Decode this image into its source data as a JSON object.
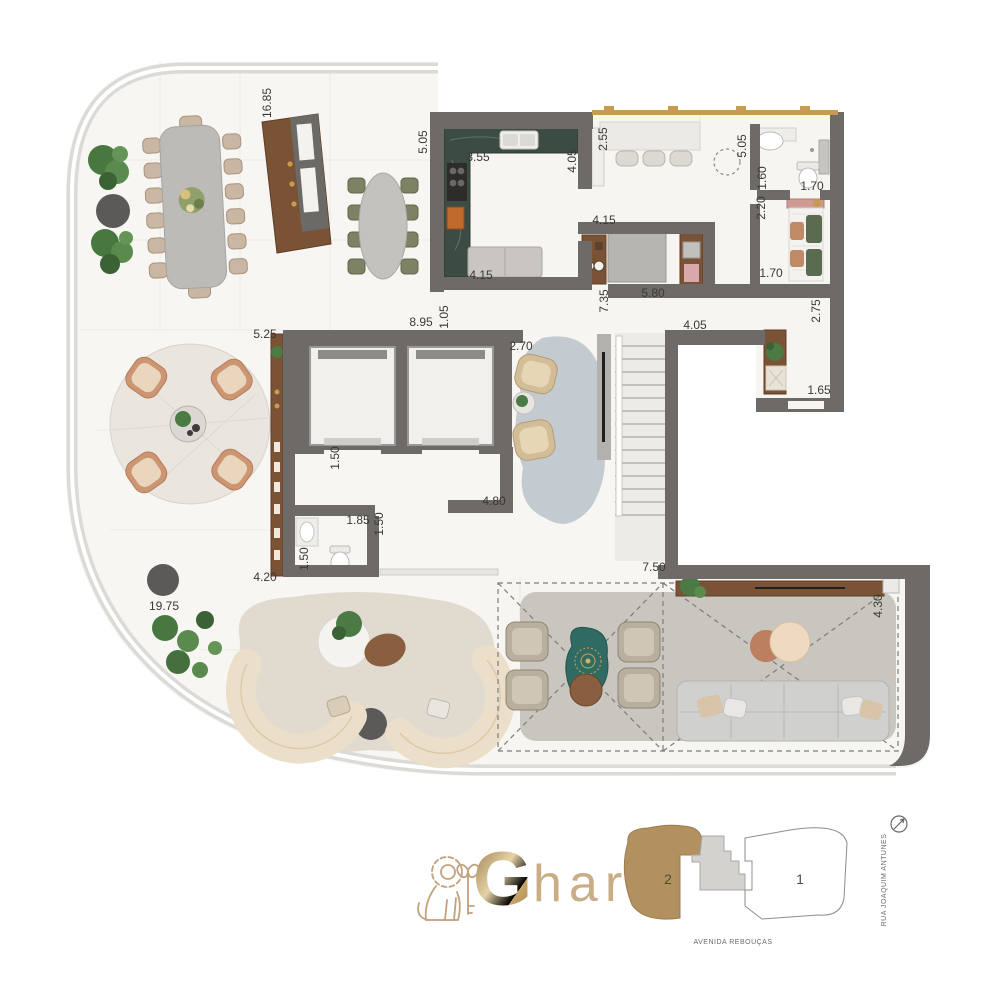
{
  "colors": {
    "wall": "#6d6a67",
    "slab_band": "#d9d7d4",
    "floor": "#f8f6f2",
    "kitchen_counter_green": "#3c4c45",
    "wood": "#7a5236",
    "window_gold": "#c79b50",
    "logo_gold": "#c2a17c",
    "keyplan_highlight": "#b3905f",
    "teal_table": "#2f6b62",
    "rug_blue_gray": "#bec6cc",
    "terrace_rug_gray": "#c9c6c0",
    "sofa_cream": "#ecdfc9"
  },
  "plan": {
    "dimensions": [
      "16.85",
      "5.05",
      "3.55",
      "4.05",
      "2.55",
      "5.05",
      "1.60",
      "1.70",
      "2.20",
      "1.70",
      "2.75",
      "4.15",
      "4.15",
      "7.35",
      "5.80",
      "8.95",
      "1.05",
      "2.70",
      "4.05",
      "5.25",
      "1.65",
      "1.50",
      "4.80",
      "1.85",
      "1.50",
      "1.50",
      "4.20",
      "19.75",
      "7.50",
      "4.30"
    ]
  },
  "branding": {
    "logo_lead": "G",
    "logo_rest": "har"
  },
  "keyplan": {
    "units": [
      {
        "label": "2"
      },
      {
        "label": "1"
      }
    ],
    "streets": {
      "right": "RUA JOAQUIM ANTUNES",
      "bottom": "AVENIDA REBOUÇAS"
    }
  }
}
